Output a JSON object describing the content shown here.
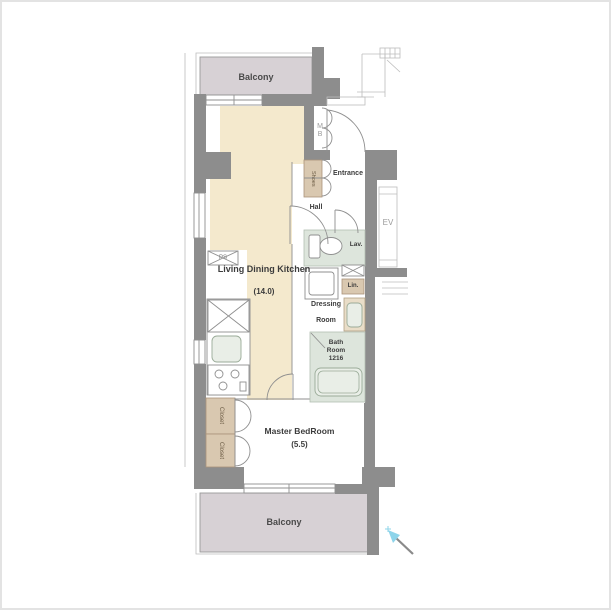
{
  "colors": {
    "wall": "#8d8d8d",
    "balcony": "#d7d1d5",
    "floor": "#f4e9cd",
    "cabinet": "#d9c8b0",
    "wet": "#dde5dc",
    "north": "#8ed4ea"
  },
  "rooms": {
    "balcony_top": "Balcony",
    "balcony_bottom": "Balcony",
    "ldk": "Living Dining Kitchen",
    "ldk_size": "(14.0)",
    "master_bedroom": "Master BedRoom",
    "master_size": "(5.5)",
    "entrance": "Entrance",
    "hall": "Hall",
    "dressing_line1": "Dressing",
    "dressing_line2": "Room",
    "bath_line1": "Bath",
    "bath_line2": "Room",
    "bath_line3": "1216",
    "lavatory": "Lav.",
    "linen": "Lin.",
    "pipe_space": "PS",
    "meter_box": "MB",
    "elevator": "EV",
    "closet": "Closet",
    "shoes": "Shoes"
  }
}
